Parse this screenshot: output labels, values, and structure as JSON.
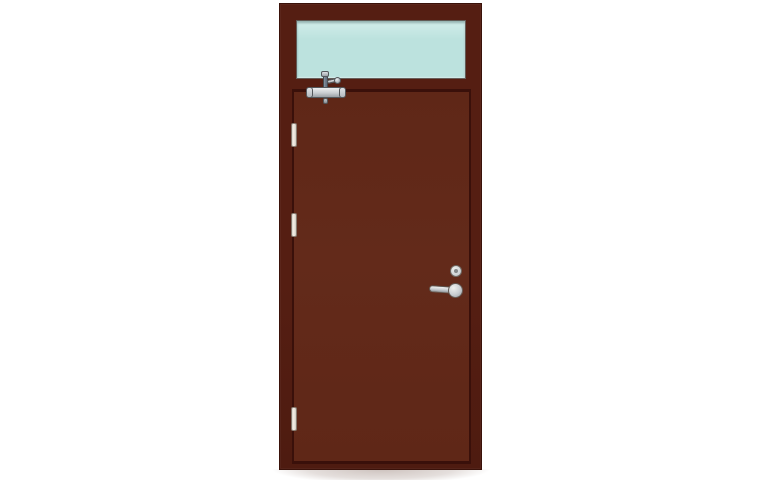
{
  "scene": {
    "description": "Product illustration of a dark brown steel fire-rated door with a glazed transom panel above, shown closed on a plain white background",
    "labels": {
      "door_assembly": "Fire door with transom window",
      "frame": "Door frame",
      "transom_window": "Transom window glass",
      "door_leaf": "Door leaf",
      "door_closer": "Overhead door closer",
      "hinge_top": "Top hinge",
      "hinge_middle": "Middle hinge",
      "hinge_bottom": "Bottom hinge",
      "cylinder_lock": "Cylinder lock",
      "lever_handle": "Lever handle",
      "shadow": "Floor shadow"
    }
  },
  "colors": {
    "background": "#ffffff",
    "frame": "#551e12",
    "frame_edge": "#3a120a",
    "leaf": "#5f2717",
    "leaf_gap": "#3a100a",
    "glass": "#bce2de",
    "glass_light": "#d2edea",
    "silver": "#c9cdd1",
    "silver_light": "#eceef0",
    "silver_dark": "#9aa0a6",
    "hardware_outline": "#54585c",
    "arm": "#667180",
    "hinge": "#f5f0e8"
  }
}
